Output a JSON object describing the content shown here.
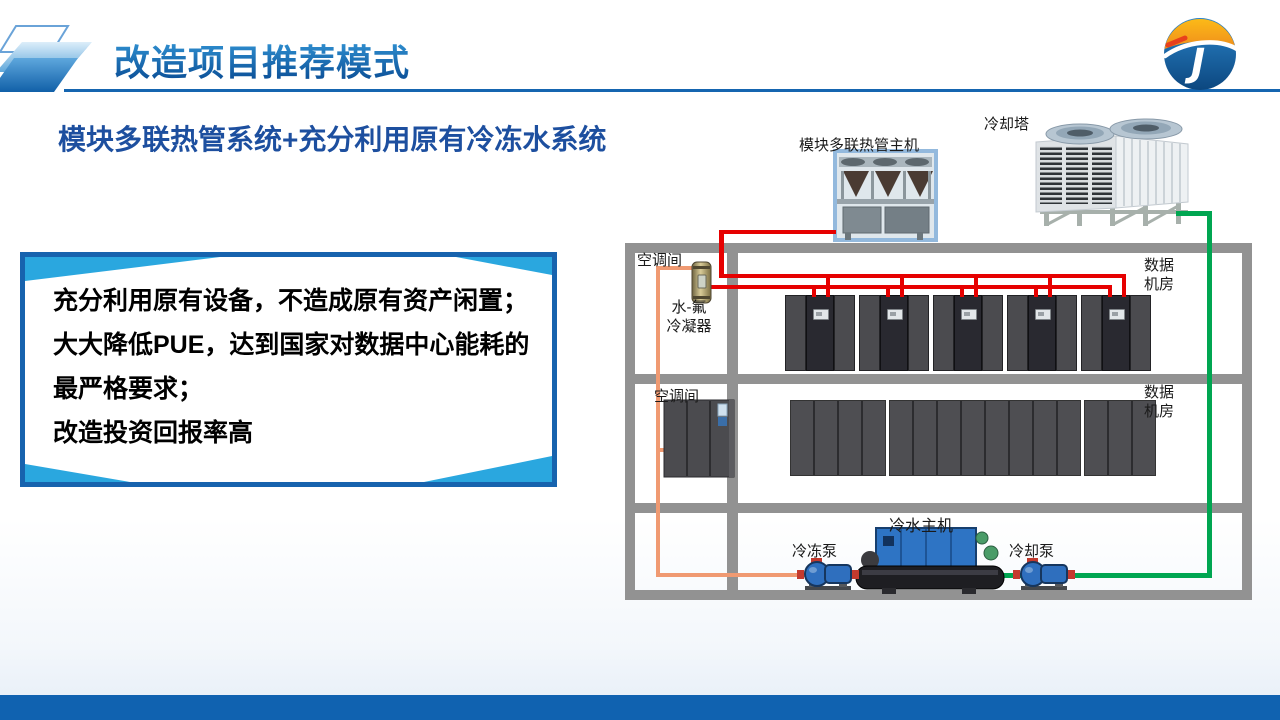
{
  "header": {
    "title": "改造项目推荐模式",
    "logo_icon": "jp-circle-logo"
  },
  "subtitle": "模块多联热管系统+充分利用原有冷冻水系统",
  "benefits": {
    "lines": [
      "充分利用原有设备，不造成原有资产闲置；",
      "大大降低PUE，达到国家对数据中心能耗的",
      "最严格要求；",
      "改造投资回报率高"
    ]
  },
  "diagram": {
    "labels": {
      "heat_pipe_unit": "模块多联热管主机",
      "cooling_tower": "冷却塔",
      "ac_room": "空调间",
      "condenser_line1": "水-氟",
      "condenser_line2": "冷凝器",
      "data_room_line1": "数据",
      "data_room_line2": "机房",
      "chiller": "冷水主机",
      "chilled_pump": "冷冻泵",
      "cooling_pump": "冷却泵"
    },
    "floor1_rack_groups": 5,
    "floor2_rack_sections": [
      4,
      8,
      3
    ],
    "colors": {
      "refrigerant_red": "#e60000",
      "chilled_water_orange": "#f09a72",
      "cooling_water_green": "#00a651",
      "wall_gray": "#929292",
      "accent_blue": "#1565b0",
      "box_border_blue": "#1763ae",
      "box_accent_blue": "#2aa7df",
      "footer_blue": "#1062b0"
    }
  }
}
